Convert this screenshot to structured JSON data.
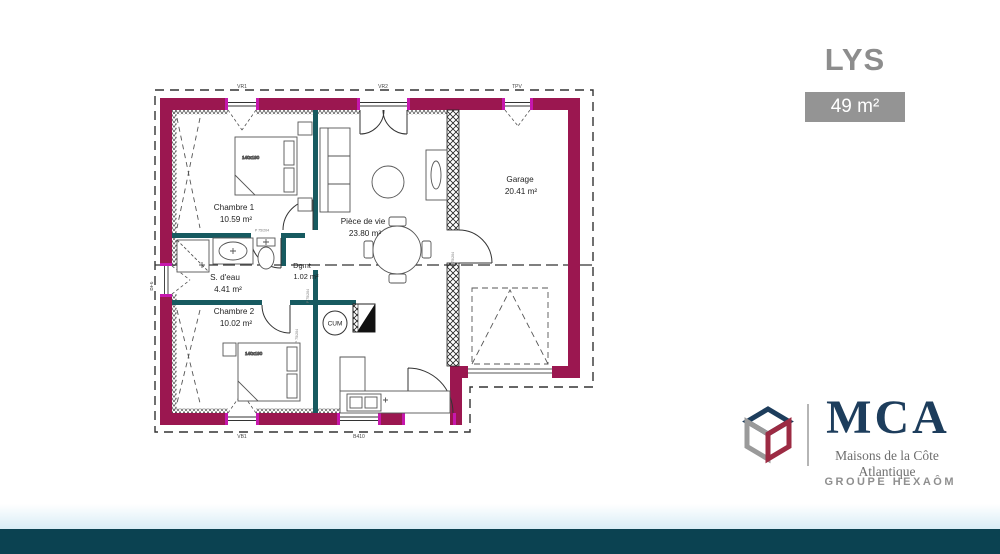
{
  "header": {
    "title": "LYS",
    "area_badge": "49 m²"
  },
  "plan": {
    "rooms": [
      {
        "name": "Chambre 1",
        "area": "10.59 m²"
      },
      {
        "name": "S. d'eau",
        "area": "4.41 m²"
      },
      {
        "name": "Chambre 2",
        "area": "10.02 m²"
      },
      {
        "name": "Pièce de vie",
        "area": "23.80 m²"
      },
      {
        "name": "Dgmt",
        "area": "1.02 m²"
      },
      {
        "name": "Garage",
        "area": "20.41 m²"
      }
    ],
    "water_heater_label": "CUM",
    "bed_label": "140x190",
    "door_label": "P 75/204",
    "openings": {
      "top_left": "VR1",
      "top_center": "VR2",
      "top_right": "TPV",
      "left": "BF6",
      "bottom_left": "VB1",
      "bottom_center": "B410"
    }
  },
  "branding": {
    "name": "MCA",
    "tagline": "Maisons de la Côte Atlantique",
    "group": "GROUPE HEXAÔM"
  },
  "colors": {
    "wall": "#9b1750",
    "wall_accent": "#c617ad",
    "partition": "#175a60",
    "footer_bar": "#0b4251",
    "navy": "#1d3d5c",
    "logo_red": "#9c2b43",
    "logo_gray": "#9a9a9a",
    "title_gray": "#8d8d8d",
    "badge_bg": "#949494"
  }
}
